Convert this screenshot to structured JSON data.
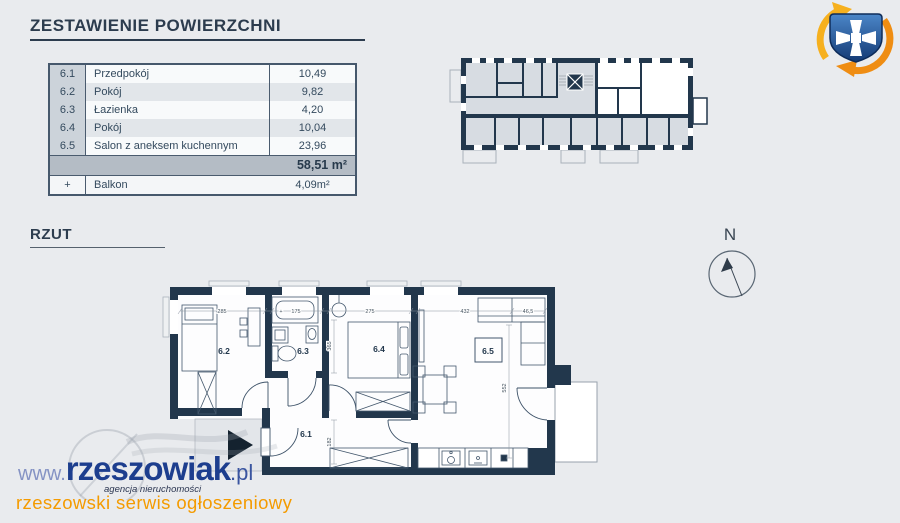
{
  "title": {
    "text": "ZESTAWIENIE POWIERZCHNI"
  },
  "summary": {
    "rows": [
      {
        "no": "6.1",
        "name": "Przedpokój",
        "area": "10,49"
      },
      {
        "no": "6.2",
        "name": "Pokój",
        "area": "9,82"
      },
      {
        "no": "6.3",
        "name": "Łazienka",
        "area": "4,20"
      },
      {
        "no": "6.4",
        "name": "Pokój",
        "area": "10,04"
      },
      {
        "no": "6.5",
        "name": "Salon z aneksem kuchennym",
        "area": "23,96"
      }
    ],
    "total_area": "58,51 m²",
    "balcony": {
      "no": "+",
      "name": "Balkon",
      "area": "4,09m²"
    }
  },
  "section": {
    "rzut_label": "RZUT"
  },
  "compass": {
    "north_label": "N"
  },
  "plan": {
    "room_labels": {
      "r61": "6.1",
      "r62": "6.2",
      "r63": "6.3",
      "r64": "6.4",
      "r65": "6.5"
    },
    "dims": {
      "plus": "+",
      "w62": "285",
      "w63": "175",
      "w64": "275",
      "w65": "432",
      "w65r": "46,5",
      "h64": "365",
      "h65": "552",
      "h61": "182"
    }
  },
  "footer": {
    "url_www": "www.",
    "url_name": "rzeszowiak",
    "url_tld": ".pl",
    "agency": "agencja nieruchomości",
    "tagline": "rzeszowski serwis ogłoszeniowy"
  },
  "colors": {
    "background": "#e9ebee",
    "wall": "#22374c",
    "table_border": "#46586c",
    "brand_blue": "#1d3e8e",
    "accent_orange": "#f49b00",
    "logo_blue": "#1c4f94",
    "logo_orange": "#f0930f"
  }
}
